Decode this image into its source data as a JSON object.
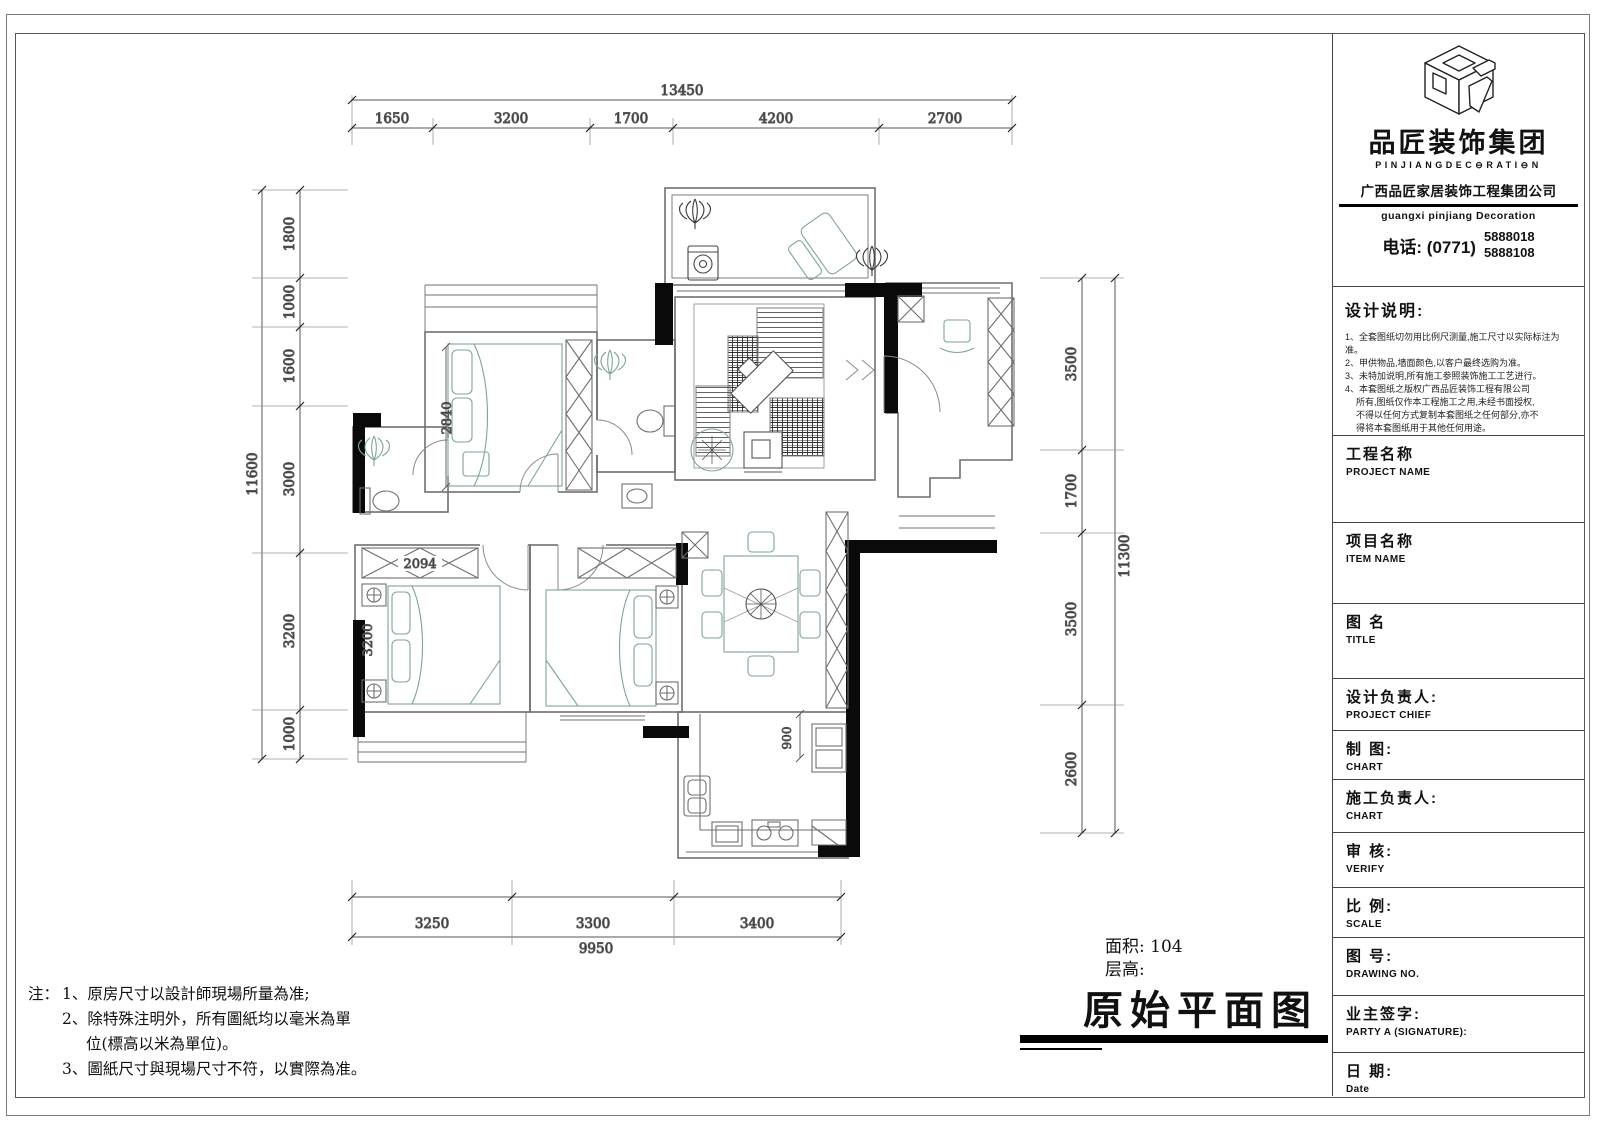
{
  "company": {
    "name_cn": "品匠装饰集团",
    "name_en": "PINJIANGDEC⊖RATI⊖N",
    "full_name_cn": "广西品匠家居装饰工程集团公司",
    "full_name_en": "guangxi pinjiang Decoration",
    "phone_label": "电话: (0771)",
    "phone_1": "5888018",
    "phone_2": "5888108"
  },
  "design_notes": {
    "title": "设计说明:",
    "line1": "1、全套图纸切勿用比例尺测量,施工尺寸以实际标注为准。",
    "line2": "2、甲供物品,墙面颜色,以客户最终选购为准。",
    "line3": "3、未特加说明,所有施工参照装饰施工工艺进行。",
    "line4": "4、本套图纸之版权广西品匠装饰工程有限公司",
    "line5": "所有,图纸仅作本工程施工之用,未经书面授权,",
    "line6": "不得以任何方式复制本套图纸之任何部分,亦不",
    "line7": "得将本套图纸用于其他任何用途。"
  },
  "title_block_fields": [
    {
      "cn": "工程名称",
      "en": "PROJECT NAME"
    },
    {
      "cn": "项目名称",
      "en": "ITEM  NAME"
    },
    {
      "cn": "图 名",
      "en": "TITLE"
    },
    {
      "cn": "设计负责人:",
      "en": "PROJECT CHIEF"
    },
    {
      "cn": "制  图:",
      "en": "CHART"
    },
    {
      "cn": "施工负责人:",
      "en": "CHART"
    },
    {
      "cn": "审  核:",
      "en": "VERIFY"
    },
    {
      "cn": "比  例:",
      "en": "SCALE"
    },
    {
      "cn": "图  号:",
      "en": "DRAWING NO."
    },
    {
      "cn": "业主签字:",
      "en": "PARTY A (SIGNATURE):"
    },
    {
      "cn": "日  期:",
      "en": "Date"
    }
  ],
  "footer_notes": {
    "prefix": "注：",
    "line1": "1、原房尺寸以設計師現場所量為准;",
    "line2": "2、除特殊注明外，所有圖紙均以毫米為單",
    "line3": "位(標高以米為單位)。",
    "line4": "3、圖紙尺寸與現場尺寸不符，以實際為准。"
  },
  "drawing": {
    "area_label": "面积: 104",
    "floor_height_label": "层高:",
    "title": "原始平面图"
  },
  "dimensions": {
    "top": {
      "total": "13450",
      "segments": [
        "1650",
        "3200",
        "1700",
        "4200",
        "2700"
      ]
    },
    "left": {
      "total": "11600",
      "segments": [
        "1800",
        "1000",
        "1600",
        "3000",
        "3200",
        "1000"
      ]
    },
    "right": {
      "total": "11300",
      "segments": [
        "3500",
        "1700",
        "3500",
        "2600"
      ]
    },
    "bottom": {
      "total": "9950",
      "segments": [
        "3250",
        "3300",
        "3400"
      ]
    },
    "interior": {
      "bed_depth": "2840",
      "wardrobe_width": "2094",
      "bed_width": "3200",
      "kitchen_depth": "900"
    }
  }
}
